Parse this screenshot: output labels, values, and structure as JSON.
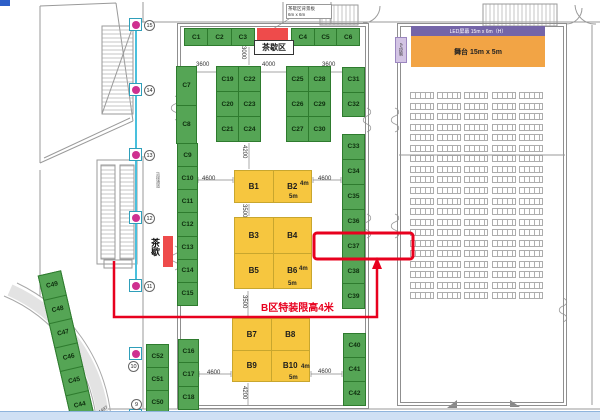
{
  "tea": {
    "top_label": "茶歇区",
    "annotation_line1": "茶歇区背景板",
    "annotation_line2": "6m x 6m",
    "side_label": "茶歇"
  },
  "stage_area": {
    "led_label": "LED屏幕 15m x 6m（H）",
    "stage_label": "舞台 15m x 5m",
    "av_label": "AV控制"
  },
  "notes": {
    "height_limit": "B区特装限高4米",
    "corridor": "货梯通道"
  },
  "booth_groups": {
    "top_left": [
      "C1",
      "C2",
      "C3"
    ],
    "top_right": [
      "C4",
      "C5",
      "C6"
    ],
    "c7_c8": [
      "C7",
      "C8"
    ],
    "c19_c24": [
      "C19",
      "C22",
      "C20",
      "C23",
      "C21",
      "C24"
    ],
    "c25_c30": [
      "C25",
      "C28",
      "C26",
      "C29",
      "C27",
      "C30"
    ],
    "c31_c32": [
      "C31",
      "C32"
    ],
    "c33_c39": [
      "C33",
      "C34",
      "C35",
      "C36",
      "C37",
      "C38",
      "C39"
    ],
    "c9_c15": [
      "C9",
      "C10",
      "C11",
      "C12",
      "C13",
      "C14",
      "C15"
    ],
    "c52_c50": [
      "C52",
      "C51",
      "C50"
    ],
    "c16_c18": [
      "C16",
      "C17",
      "C18"
    ],
    "c40_c42": [
      "C40",
      "C41",
      "C42"
    ],
    "c49_c44": [
      "C49",
      "C48",
      "C47",
      "C46",
      "C45",
      "C44"
    ]
  },
  "b_blocks": {
    "b1_b2": [
      "B1",
      "B2"
    ],
    "b3_b6": [
      "B3",
      "B4",
      "B5",
      "B6"
    ],
    "b7_b10": [
      "B7",
      "B8",
      "B9",
      "B10"
    ],
    "width_note": "4m",
    "depth_note": "5m"
  },
  "highlight": {
    "booth": "C37"
  },
  "markers": {
    "labels": [
      "15",
      "14",
      "13",
      "12",
      "11",
      "10",
      "9"
    ]
  },
  "dimensions": {
    "top_left": "3600",
    "top_mid": "4000",
    "top_right": "3600",
    "top_vert": "3000",
    "b1_top": "4200",
    "b1_left": "4600",
    "b2_right": "4600",
    "b1_b3": "3500",
    "b6_b7": "3500",
    "b9_left": "4600",
    "b10_right": "4600",
    "b9_bottom": "4200",
    "diag": "4497"
  },
  "colors": {
    "booth_green": "#55a555",
    "booth_yellow": "#f6c63f",
    "highlight_red": "#e8001e",
    "marker_pink": "#cf3090",
    "marker_teal": "#2f9fba",
    "stage_orange": "#f2a445",
    "led_purple": "#7465a8",
    "tea_red": "#ee4b4b",
    "path_cyan": "#49c0dd"
  }
}
